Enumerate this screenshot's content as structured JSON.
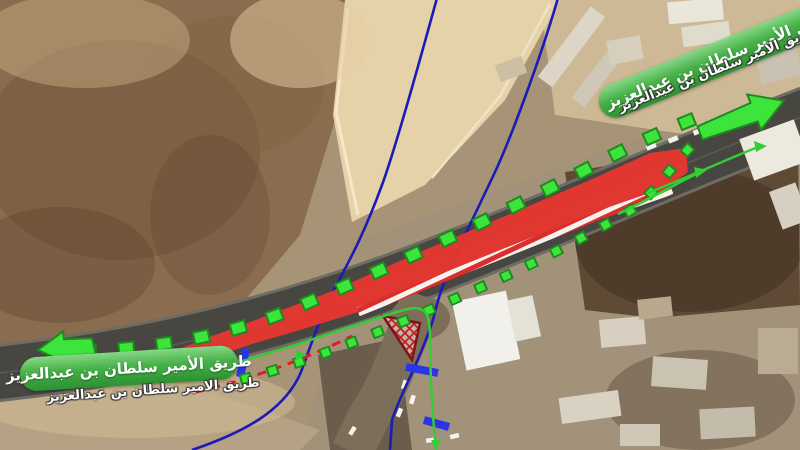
{
  "map": {
    "road_labels": {
      "top_right_banner": "طريق الأمير سلطان بن عبدالعزيز",
      "top_right_subtitle": "طريق الامير سلطان بن عبدالعزيز",
      "bottom_left_banner": "طريق الأمير سلطان بن عبدالعزيز",
      "bottom_left_subtitle": "طريق الامير سلطان بن عبدالعزيز"
    },
    "annotation_colors": {
      "route_dash_green": "#3ce43c",
      "route_dash_border": "#1f8a1f",
      "thin_route_green": "#35cc35",
      "closure_red": "#ee3630",
      "barrier_stripe_red": "#dd2c2c",
      "boundary_blue": "#1b1bb5",
      "closure_bar_blue": "#2a35e8",
      "banner_green": "#47b047"
    }
  }
}
